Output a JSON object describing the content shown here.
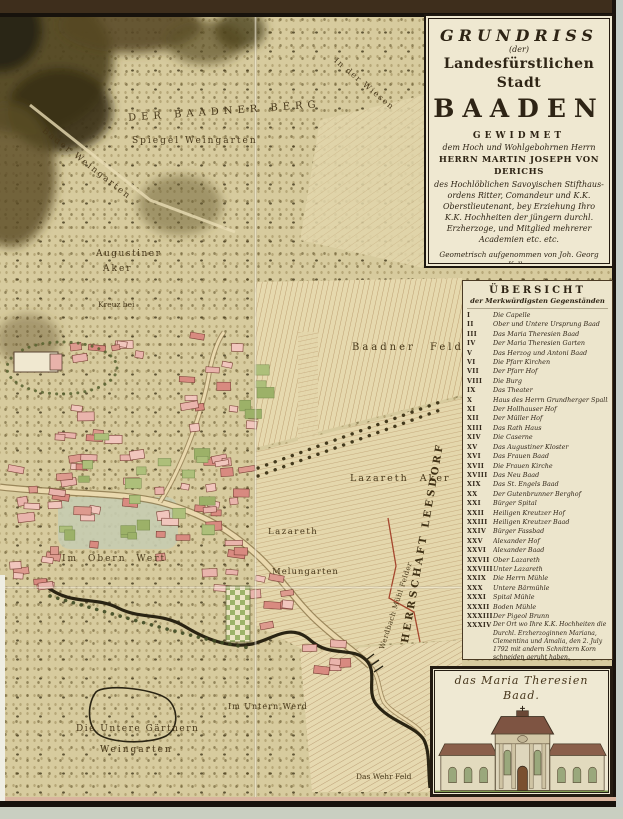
{
  "cartouche": {
    "title1": "GRUNDRISS",
    "title2": "(der)",
    "title3": "Landesfürstlichen Stadt",
    "title4": "BAADEN",
    "dedication_heading": "GEWIDMET",
    "dedication_sub": "dem Hoch und Wohlgebohrnen Herrn",
    "dedicatee": "HERRN MARTIN JOSEPH VON DERICHS",
    "dedication_lines": [
      "des Hochlöblichen Savoyischen Stifthaus-",
      "ordens Ritter, Comandeur und K.K.",
      "Oberstlieutenant, bey Erziehung Ihro",
      "K.K. Hochheiten der jüngern durchl.",
      "Erzherzoge, und Mitglied mehrerer",
      "Academien etc. etc."
    ],
    "surveyor_lines": [
      "Geometrisch aufgenommen von Joh. Georg Koller",
      "von einer Hochlöbl. K.K. N.Ö. Landesregierung",
      "zu dieser Aufnahme höchst verordneter Ingenieur"
    ],
    "engraver_line": "Gestochen von Hieronymus Benedicti in Wien 1800"
  },
  "legend": {
    "title": "ÜBERSICHT",
    "subtitle": "der Merkwürdigsten Gegenständen",
    "items": [
      {
        "numeral": "I",
        "label": "Die Capelle"
      },
      {
        "numeral": "II",
        "label": "Ober und Untere Ursprung Baad"
      },
      {
        "numeral": "III",
        "label": "Das Maria Theresien Baad"
      },
      {
        "numeral": "IV",
        "label": "Der Maria Theresien Garten"
      },
      {
        "numeral": "V",
        "label": "Das Herzog und Antoni Baad"
      },
      {
        "numeral": "VI",
        "label": "Die Pfarr Kirchen"
      },
      {
        "numeral": "VII",
        "label": "Der Pfarr Hof"
      },
      {
        "numeral": "VIII",
        "label": "Die Burg"
      },
      {
        "numeral": "IX",
        "label": "Das Theater"
      },
      {
        "numeral": "X",
        "label": "Haus des Herrn Grundherger Spallier"
      },
      {
        "numeral": "XI",
        "label": "Der Hollhauser Hof"
      },
      {
        "numeral": "XII",
        "label": "Der Müller Hof"
      },
      {
        "numeral": "XIII",
        "label": "Das Rath Haus"
      },
      {
        "numeral": "XIV",
        "label": "Die Caserne"
      },
      {
        "numeral": "XV",
        "label": "Das Augustiner Kloster"
      },
      {
        "numeral": "XVI",
        "label": "Das Frauen Baad"
      },
      {
        "numeral": "XVII",
        "label": "Die Frauen Kirche"
      },
      {
        "numeral": "XVIII",
        "label": "Das Neu Baad"
      },
      {
        "numeral": "XIX",
        "label": "Das St. Engels Baad"
      },
      {
        "numeral": "XX",
        "label": "Der Gutenbrunner Berghof"
      },
      {
        "numeral": "XXI",
        "label": "Bürger Spital"
      },
      {
        "numeral": "XXII",
        "label": "Heiligen Kreutzer Hof"
      },
      {
        "numeral": "XXIII",
        "label": "Heiligen Kreutzer Baad"
      },
      {
        "numeral": "XXIV",
        "label": "Bürger Fassbad"
      },
      {
        "numeral": "XXV",
        "label": "Alexander Hof"
      },
      {
        "numeral": "XXVI",
        "label": "Alexander Baad"
      },
      {
        "numeral": "XXVII",
        "label": "Ober Lazareth"
      },
      {
        "numeral": "XXVIII",
        "label": "Unter Lazareth"
      },
      {
        "numeral": "XXIX",
        "label": "Die Herrn Mühle"
      },
      {
        "numeral": "XXX",
        "label": "Untere Bärmühle"
      },
      {
        "numeral": "XXXI",
        "label": "Spital Mühle"
      },
      {
        "numeral": "XXXII",
        "label": "Boden Mühle"
      },
      {
        "numeral": "XXXIII",
        "label": "Der Pigeol Brunn"
      },
      {
        "numeral": "XXXIV",
        "label": "Der Ort wo Ihre K.K. Hochheiten die Durchl. Erzherzoginnen Mariana, Clementina und Amalia, den 2. July 1792 mit andern Schnittern Korn schneiden geruht haben."
      }
    ]
  },
  "inset": {
    "title": "das Maria Theresien Baad."
  },
  "map": {
    "labels": [
      {
        "id": "der-baadner-berg",
        "text": "DER BAADNER BERG"
      },
      {
        "id": "spiegel-weingarten",
        "text": "Spiegel Weingarten"
      },
      {
        "id": "bader-weingarten",
        "text": "Bader Weingarten"
      },
      {
        "id": "in-der-wiesen",
        "text": "In der Wiesen"
      },
      {
        "id": "augustiner",
        "text": "Augustiner"
      },
      {
        "id": "aker",
        "text": "Aker"
      },
      {
        "id": "kreuz-bei",
        "text": "Kreuz bei"
      },
      {
        "id": "baadner-feld",
        "text": "Baadner Feld"
      },
      {
        "id": "lazareth-aker",
        "text": "Lazareth Aker"
      },
      {
        "id": "lazareth",
        "text": "Lazareth"
      },
      {
        "id": "melungarten",
        "text": "Melungarten"
      },
      {
        "id": "im-obern-wert",
        "text": "Im Obern Wert"
      },
      {
        "id": "die-untere-gaertnern",
        "text": "Die Untere Gärtnern"
      },
      {
        "id": "weingarten",
        "text": "Weingarten"
      },
      {
        "id": "im-untern-werd",
        "text": "Im Untern Werd"
      },
      {
        "id": "das-wehr-feld",
        "text": "Das Wehr Feld"
      },
      {
        "id": "werdbach-muehl-felder",
        "text": "Werdbach Mühl Felder"
      },
      {
        "id": "herrschaft-leesdorf",
        "text": "HERRSCHAFT LEESDORF"
      }
    ]
  },
  "colors": {
    "parchment": "#d7cb9e",
    "hill_dark": "#3a3116",
    "town_pink": "#e9b4ac",
    "garden_green": "#adbf7a",
    "river_ink": "#2a2413",
    "boundary_red": "#a5472e",
    "cartouche_bg": "#efe8d1",
    "border_ink": "#1f1810"
  }
}
